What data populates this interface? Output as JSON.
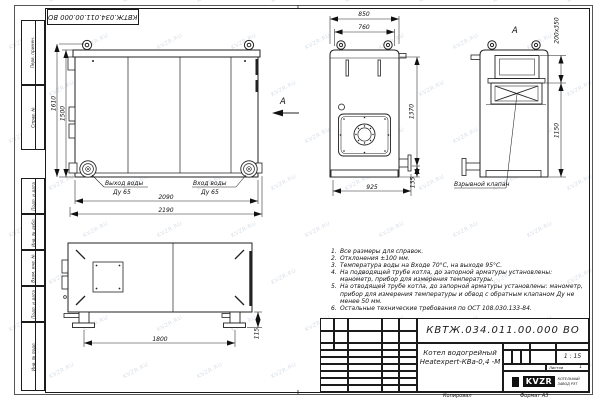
{
  "watermark": {
    "text": "KVZR.RU"
  },
  "stamp_top": "КВТЖ.034.011.00.000 ВО",
  "left_strip": [
    "Перв. примен.",
    "Справ. №",
    "Подп. и дата",
    "Инв. № дубл.",
    "Взам. инв. №",
    "Подп. и дата",
    "Инв. № подл."
  ],
  "views": {
    "side": {
      "dim_height_outer": "1610",
      "dim_height_inner": "1500",
      "dim_width_inner": "2090",
      "dim_width_outer": "2190",
      "outlet_line1": "Выход воды",
      "outlet_line2": "Ду 65",
      "inlet_line1": "Вход воды",
      "inlet_line2": "Ду 65",
      "view_arrow": "А"
    },
    "front": {
      "dim_width_outer": "850",
      "dim_width_inner": "760",
      "dim_height": "1370",
      "dim_bottom": "925",
      "dim_conn": "135"
    },
    "rear": {
      "label": "А",
      "dim_vent": "200х350",
      "dim_height": "1150",
      "valve_label": "Взрывной клапан"
    },
    "plan": {
      "dim_length": "1800",
      "dim_foot": "115"
    }
  },
  "notes": [
    {
      "num": "1.",
      "text": "Все размеры для справок."
    },
    {
      "num": "2.",
      "text": "Отклонения ±100 мм."
    },
    {
      "num": "3.",
      "text": "Температура воды на Входе 70°С, на выходе 95°С."
    },
    {
      "num": "4.",
      "text": "На подводящей трубе котла, до запорной арматуры установлены: манометр, прибор для измерения температуры."
    },
    {
      "num": "5.",
      "text": "На отводящей трубе котла, до запорной арматуры установлены: манометр, прибор для измерения температуры и обвод с обратным клапаном Ду не менее 50 мм."
    },
    {
      "num": "6.",
      "text": "Остальные технические требования по ОСТ 108.030.133-84."
    }
  ],
  "title_block": {
    "doc_number": "КВТЖ.034.011.00.000 ВО",
    "product_line1": "Котел водогрейный",
    "product_line2": "Heatexpert-КВа-0,4 -М",
    "col_izm": "Изм.",
    "col_list": "Лист",
    "col_doc": "№ докум.",
    "col_podp": "Подп.",
    "col_data": "Дата",
    "rows": [
      "Разраб.",
      "Пров.",
      "Т. контр.",
      "Нач.отд.",
      "Н. контр.",
      "Утв."
    ],
    "lit": "Лит.",
    "massa": "Масса",
    "masshtab": "Масштаб",
    "scale": "1 : 15",
    "list": "Лист",
    "listov": "Листов",
    "listov_value": "1",
    "logo": "KVZR",
    "company_line1": "КОТЕЛЬНЫЙ",
    "company_line2": "ЗАВОД РЭТ",
    "kopiroval": "Копировал",
    "format": "Формат А3"
  }
}
